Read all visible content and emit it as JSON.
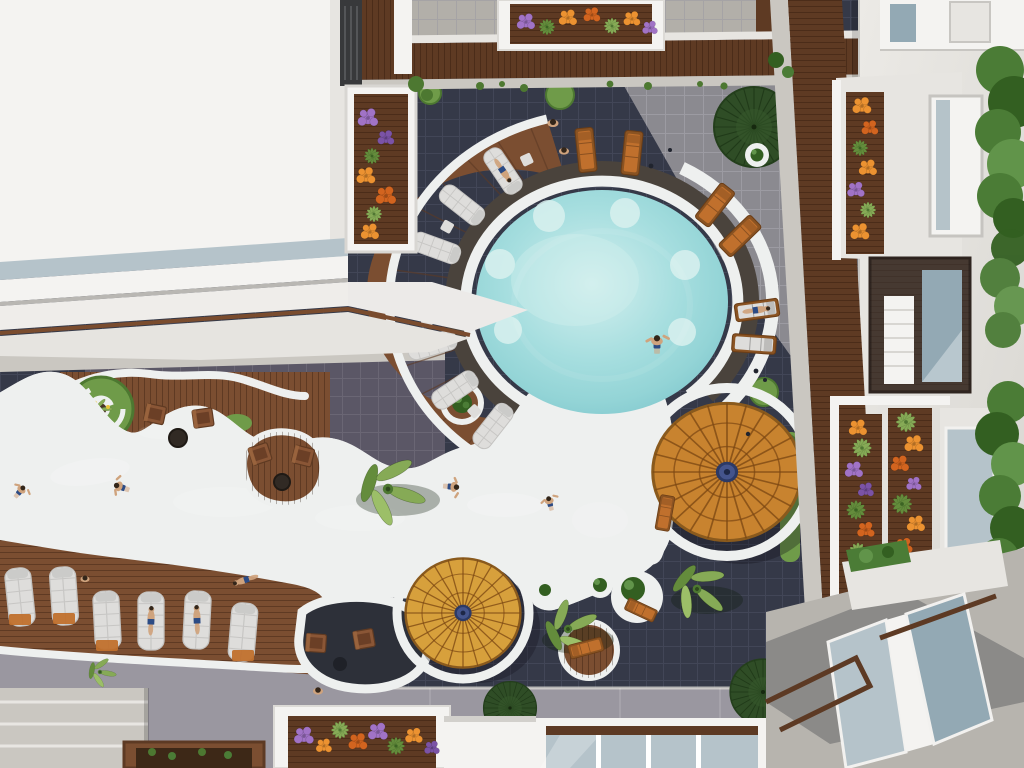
{
  "scene": {
    "type": "3D architectural aerial render",
    "setting": "Resort courtyard, top-down view of a free-form lagoon pool winding between a white rooftop, dark tiled patios, wooden sun decks and apartment balconies with flower planters",
    "lighting": "Bright daylight with hard diagonal building shadows"
  },
  "labels": {
    "scene": "Aerial view of resort pool courtyard",
    "round_pool": "Round lagoon pool",
    "lazy_river": "Winding lazy-river pool",
    "sun_deck": "Curved wooden sun deck with loungers",
    "parasol_large": "Large round timber parasol",
    "parasol_small": "Small round timber parasol",
    "walkway": "Wooden walkway",
    "rooftop": "White building rooftop",
    "apartments": "Apartment facade with balconies",
    "top_planter": "Balcony flower planter",
    "left_balcony": "Rooftop balcony planter",
    "lounger_rows": "Rows of white sun loungers",
    "patio": "Stone patio with armchairs",
    "spiral_island": "Spiral grass island planter",
    "ring_planter": "Round planter",
    "hedges": "Clipped hedges",
    "palm": "Palm tree",
    "people": "Guests swimming and sunbathing",
    "chairs": "Timber armchairs",
    "bottom_planter": "Courtyard flower planter box",
    "glass_balcony": "Glazed balcony roofs"
  },
  "counts": {
    "parasols": 2,
    "large_palm_trees": 4,
    "mini_palms": 4,
    "dark_fan_shrubs": 3,
    "white_loungers": 13,
    "orange_loungers": 9,
    "timber_armchairs": 6,
    "people_visible": 15,
    "flower_planters": 7
  },
  "colors": {
    "tile_dark": "#353948",
    "tile_line": "#434859",
    "tile_mid": "#5b5766",
    "tile_mid_line": "#6a6674",
    "tile_light": "#8b8a90",
    "tile_light_line": "#9c9ba2",
    "white_path": "#eef0ef",
    "concrete": "#cac7c1",
    "concrete_dark": "#b2afa9",
    "stone": "#4a433c",
    "wood": "#7b4e31",
    "wood_dark": "#5d3a24",
    "walkway": "#5e3a23",
    "water_light": "#c2eaea",
    "water": "#9cdadc",
    "water_deep": "#8aced3",
    "parasol": "#c8832f",
    "parasol2": "#d7a03c",
    "parasol_line": "#7a4612",
    "grass": "#6f9b49",
    "grass_dark": "#4d7831",
    "fan": "#2f4d26",
    "fan_line": "#203a19",
    "palm1": "#86aa56",
    "palm2": "#648c3c",
    "palm3": "#9cbf68",
    "hedge": "#4b7c36",
    "hedge_dark": "#335f21",
    "hedge_light": "#61944a",
    "flower_orange": "#ec9231",
    "flower_orange2": "#d2641f",
    "flower_purple": "#a173c6",
    "flower_purple2": "#7b53a6",
    "flower_yellow": "#e8c43c",
    "roof": "#f4f3f1",
    "roof_shade": "#e7e5e1",
    "wall": "#e4e2de",
    "glass": "#b5c3ca",
    "glass_dark": "#93a9b4",
    "frame": "#38393b",
    "skin": "#cfa37d",
    "hair": "#33261a",
    "suit": "#2c4b84",
    "cushion_white": "#dedddb",
    "cushion_line": "#c4c3c1",
    "cushion_orange": "#c0702d",
    "soil": "#4a3526"
  }
}
